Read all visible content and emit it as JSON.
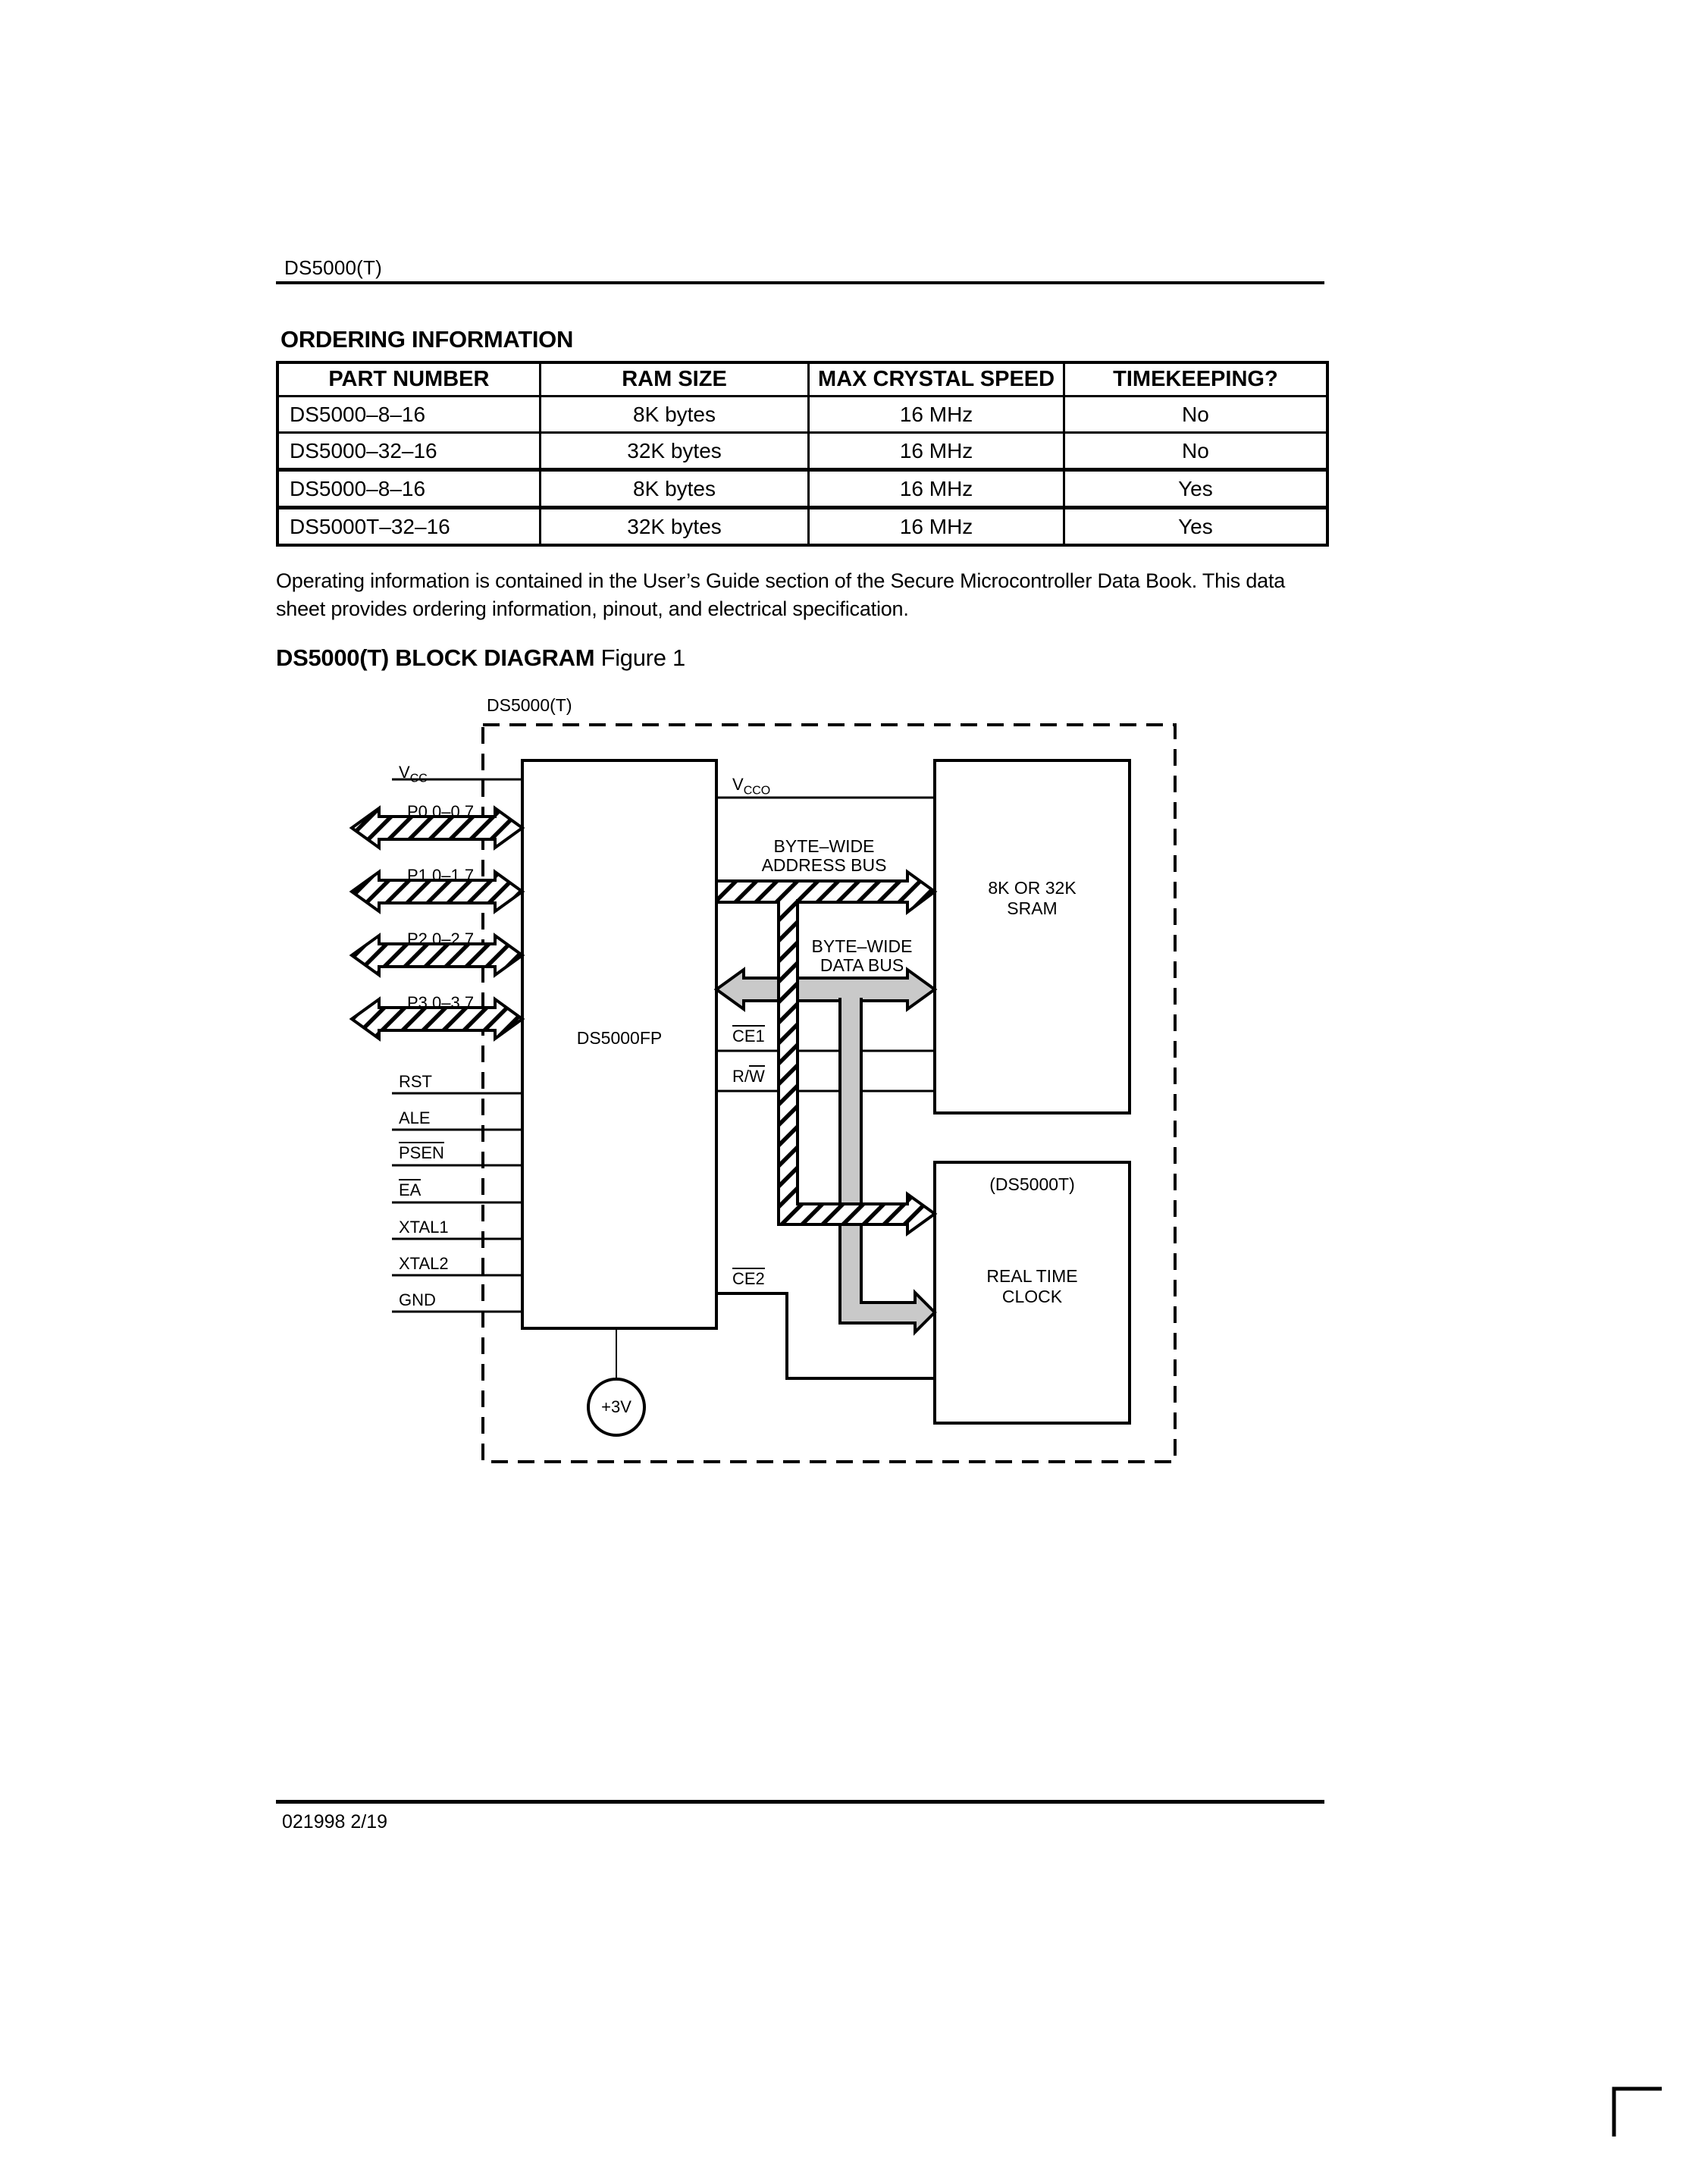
{
  "header": {
    "doc_id": "DS5000(T)"
  },
  "ordering": {
    "title": "ORDERING INFORMATION",
    "table": {
      "headers": [
        "PART NUMBER",
        "RAM SIZE",
        "MAX CRYSTAL SPEED",
        "TIMEKEEPING?"
      ],
      "rows": [
        [
          "DS5000–8–16",
          "8K bytes",
          "16 MHz",
          "No"
        ],
        [
          "DS5000–32–16",
          "32K bytes",
          "16 MHz",
          "No"
        ],
        [
          "DS5000–8–16",
          "8K bytes",
          "16 MHz",
          "Yes"
        ],
        [
          "DS5000T–32–16",
          "32K bytes",
          "16 MHz",
          "Yes"
        ]
      ]
    },
    "paragraph": "Operating information is contained in the User’s Guide section of the Secure Microcontroller Data Book.  This data sheet provides ordering information, pinout, and electrical specification."
  },
  "figure": {
    "heading_bold": "DS5000(T) BLOCK DIAGRAM",
    "heading_regular": "Figure 1",
    "envelope_label": "DS5000(T)",
    "cpu_label": "DS5000FP",
    "sram_label": [
      "8K OR 32K",
      "SRAM"
    ],
    "rtc_tag": "(DS5000T)",
    "rtc_label": [
      "REAL TIME",
      "CLOCK"
    ],
    "address_bus_label": [
      "BYTE–WIDE",
      "ADDRESS BUS"
    ],
    "data_bus_label": [
      "BYTE–WIDE",
      "DATA BUS"
    ],
    "battery_label": "+3V",
    "left_pins": [
      {
        "label": "V",
        "sub": "CC"
      },
      {
        "label": "P0.0–0.7",
        "bus": true
      },
      {
        "label": "P1.0–1.7",
        "bus": true
      },
      {
        "label": "P2.0–2.7",
        "bus": true
      },
      {
        "label": "P3.0–3.7",
        "bus": true
      },
      {
        "label": "RST"
      },
      {
        "label": "ALE"
      },
      {
        "label": "PSEN",
        "overline": true
      },
      {
        "label": "EA",
        "overline": true
      },
      {
        "label": "XTAL1"
      },
      {
        "label": "XTAL2"
      },
      {
        "label": "GND"
      }
    ],
    "vcco": {
      "name": "V",
      "sub": "CCO"
    },
    "ce1": "CE1",
    "rw_prefix": "R/",
    "rw_overlined": "W",
    "ce2": "CE2"
  },
  "footer": {
    "code": "021998 2/19"
  },
  "colors": {
    "ink": "#000000",
    "bus_gray": "#c9c9c9",
    "paper": "#ffffff"
  }
}
